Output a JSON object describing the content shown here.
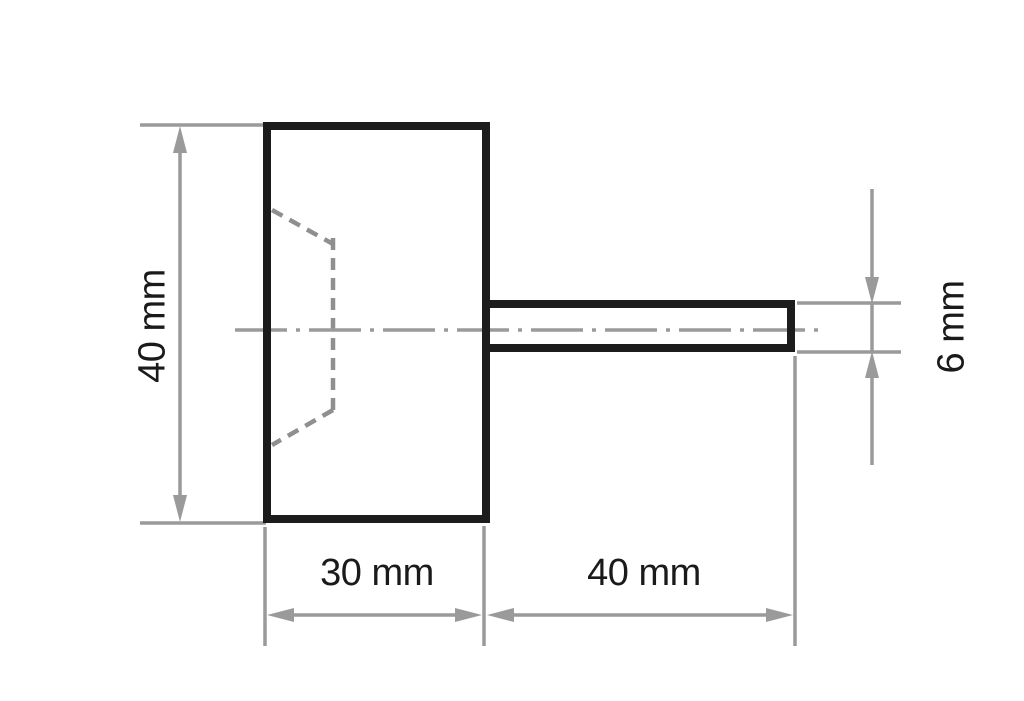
{
  "drawing": {
    "type": "technical-dimension-drawing",
    "labels": {
      "body_height": "40 mm",
      "body_width": "30 mm",
      "shank_length": "40 mm",
      "shank_diameter": "6 mm"
    },
    "colors": {
      "outline": "#1c1c1c",
      "dimension_gray": "#9a9a9a",
      "hidden_line_gray": "#8f8f8f",
      "label_text": "#1a1a1a",
      "background": "#ffffff"
    }
  }
}
